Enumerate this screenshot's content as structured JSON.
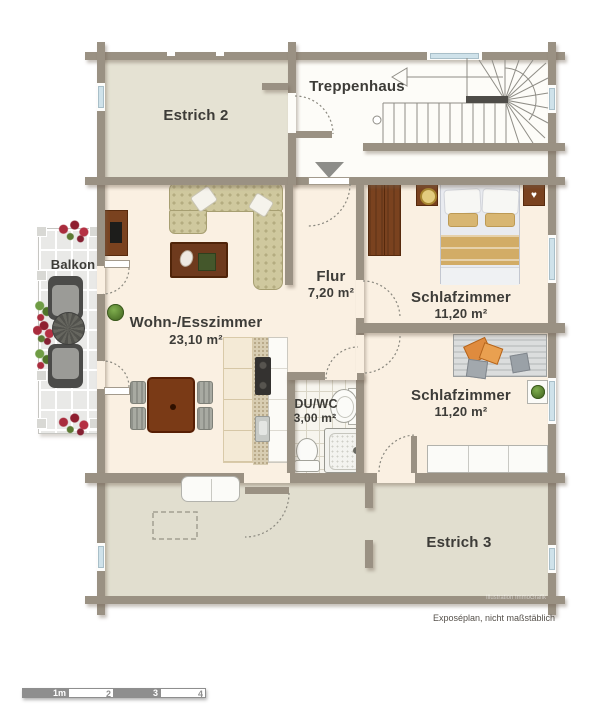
{
  "plan": {
    "labels": {
      "treppenhaus": "Treppenhaus",
      "estrich2": "Estrich 2",
      "balkon": "Balkon",
      "wohnesszimmer": "Wohn-/Esszimmer",
      "wohnesszimmer_area": "23,10 m²",
      "flur": "Flur",
      "flur_area": "7,20 m²",
      "schlafzimmer_nord": "Schlafzimmer",
      "schlafzimmer_nord_area": "11,20 m²",
      "schlafzimmer_sued": "Schlafzimmer",
      "schlafzimmer_sued_area": "11,20 m²",
      "duwc": "DU/WC",
      "duwc_area": "3,00 m²",
      "estrich3": "Estrich 3"
    },
    "footnote": "Exposéplan, nicht maßstäblich",
    "watermark": "Illustration ImmoGrafik",
    "scale_bar": {
      "labels": [
        "1m",
        "2",
        "3",
        "4"
      ]
    },
    "colors": {
      "wall": "#9a9183",
      "floor_living": "#faf0e2",
      "floor_estrich": "#e5e2d3",
      "floor_estrich3": "#e1decf",
      "window_glass": "#cfe2ea",
      "wood_dark": "#7a421f",
      "accent_orange": "#df8b3e",
      "scale_grey": "#8e8e8e"
    }
  }
}
